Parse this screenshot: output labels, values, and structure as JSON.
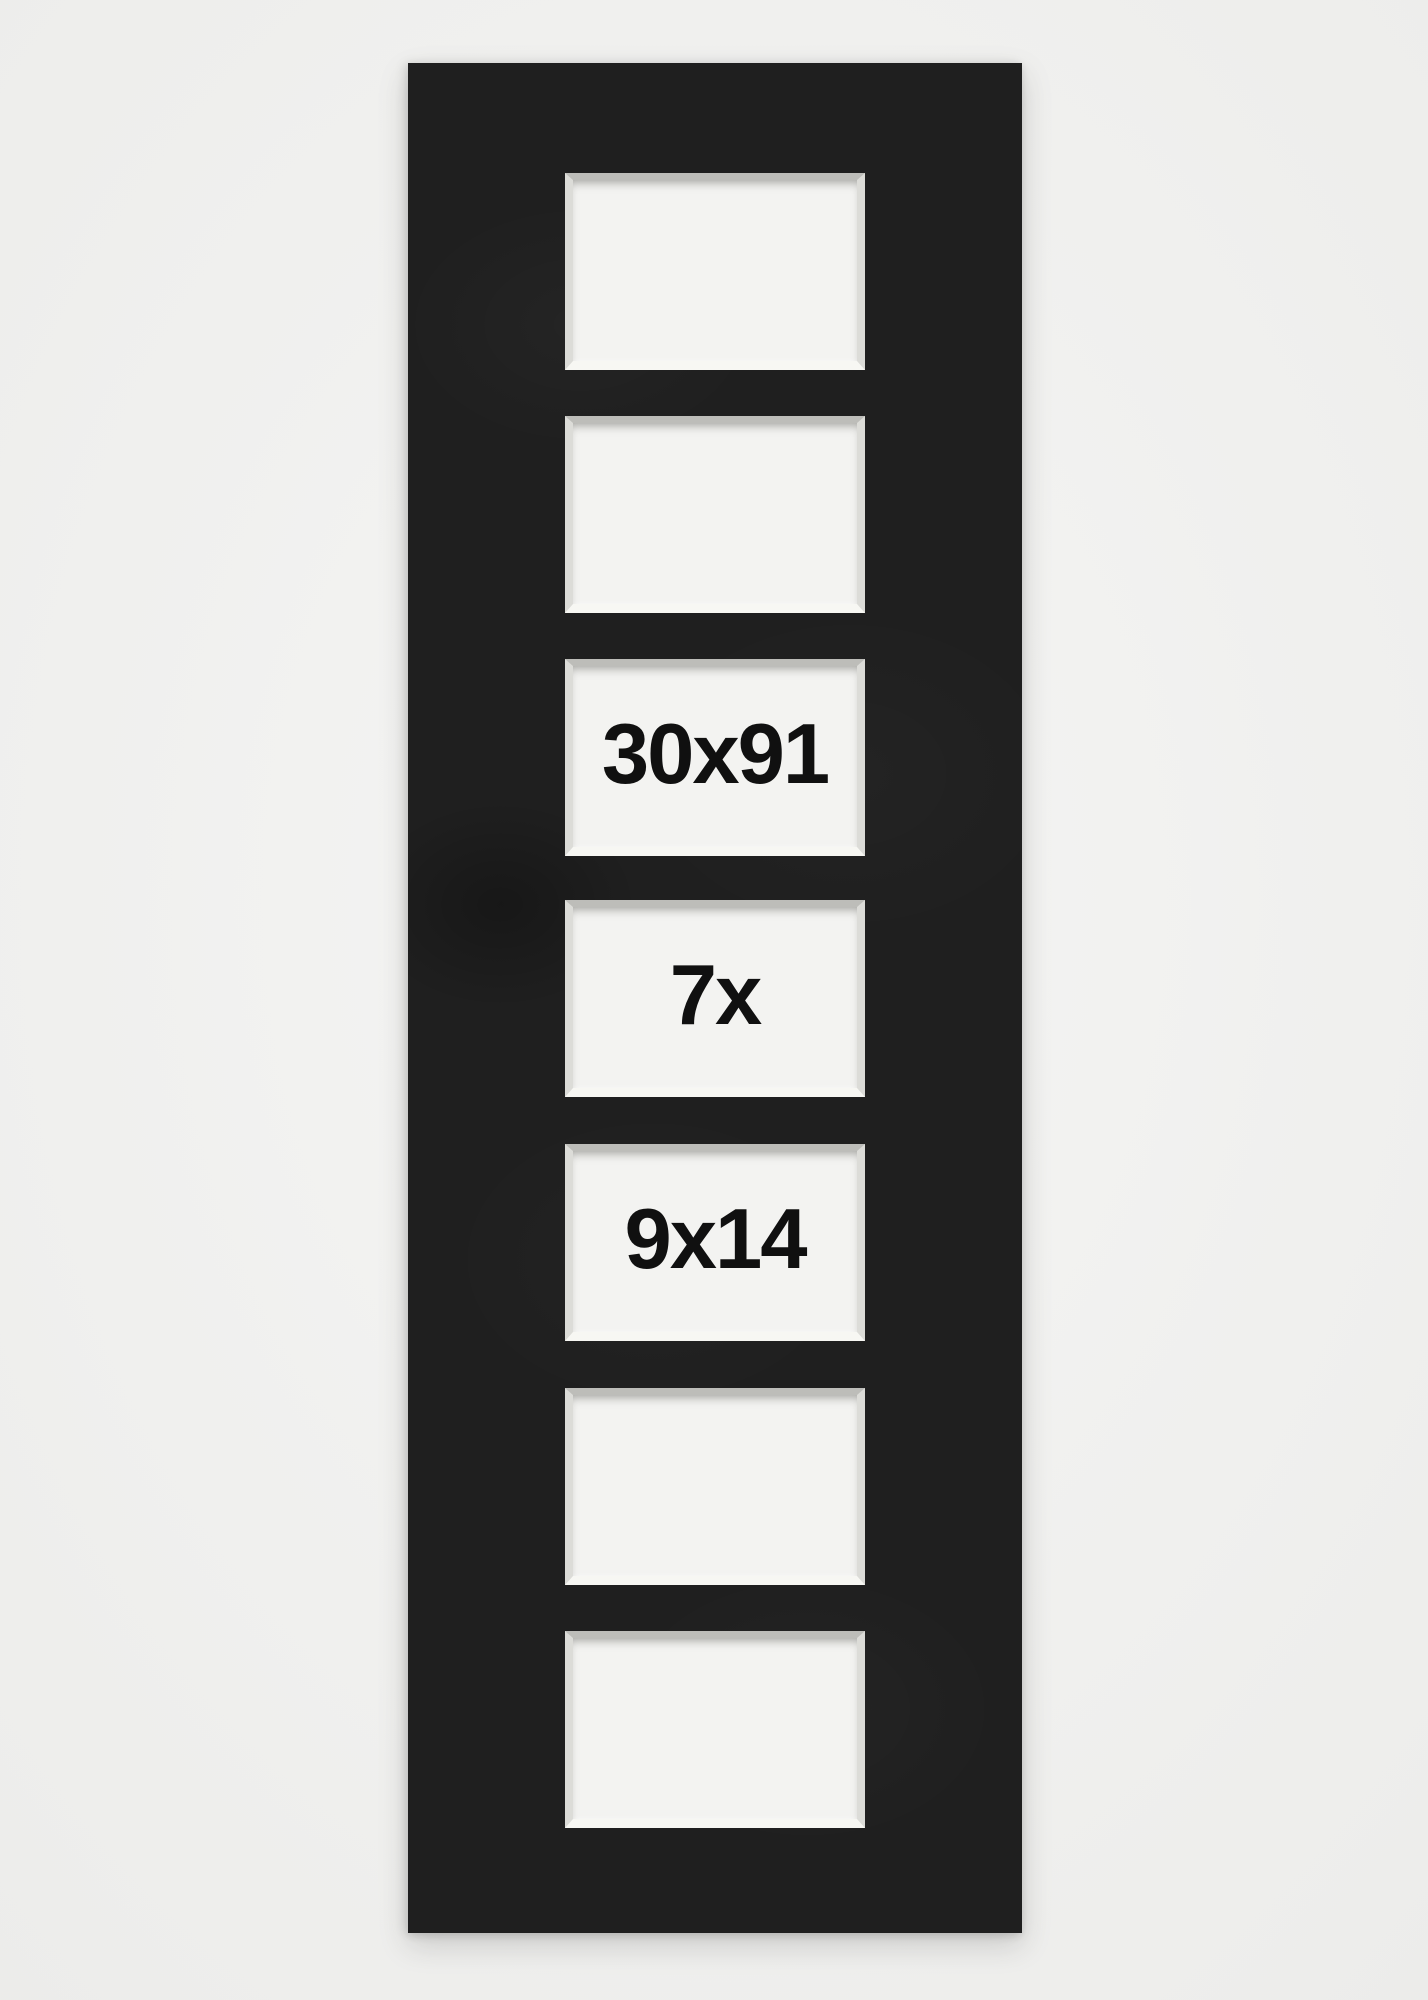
{
  "mat": {
    "mat_color": "#1f1f1f",
    "backdrop_color": "#f0f0ee",
    "aperture_fill_color": "#f3f3f1",
    "bevel_top_color": "#bdbdb9",
    "bevel_bottom_color": "#f7f7f3",
    "label_color": "#101010",
    "apertures": [
      {
        "label": ""
      },
      {
        "label": ""
      },
      {
        "label": "30x91"
      },
      {
        "label": "7x"
      },
      {
        "label": "9x14"
      },
      {
        "label": ""
      },
      {
        "label": ""
      }
    ]
  }
}
